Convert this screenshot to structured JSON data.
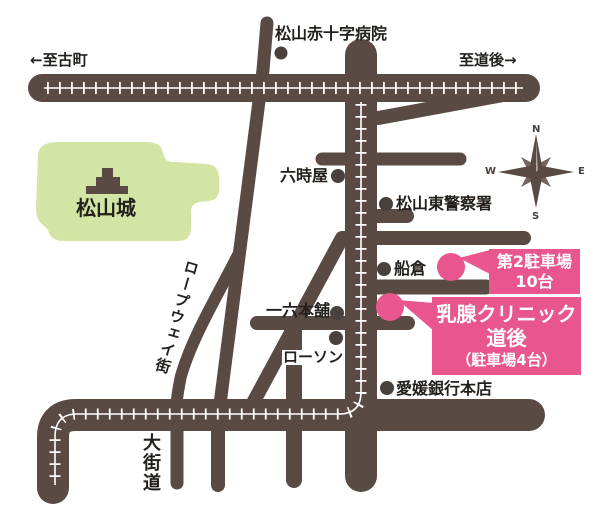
{
  "labels": {
    "hospital": "松山赤十字病院",
    "dir_west": "←至古町",
    "dir_east": "至道後→",
    "castle": "松山城",
    "rokujiya": "六時屋",
    "police": "松山東警察署",
    "funakura": "船倉",
    "ichiroku": "一六本舗",
    "lawson": "ローソン",
    "bank": "愛媛銀行本店",
    "okaido": "大街道",
    "ropeway": "ロープウェイ街"
  },
  "callouts": {
    "parking2": {
      "line1": "第2駐車場",
      "line2": "10台"
    },
    "clinic": {
      "line1": "乳腺クリニック",
      "line2": "道後",
      "line3": "（駐車場4台）"
    }
  },
  "compass": {
    "n": "N",
    "e": "E",
    "s": "S",
    "w": "W"
  },
  "colors": {
    "road": "#594b43",
    "park_green": "#d3e5a4",
    "accent_pink": "#e8568d",
    "text": "#231f1c",
    "tram_white": "#ffffff"
  }
}
